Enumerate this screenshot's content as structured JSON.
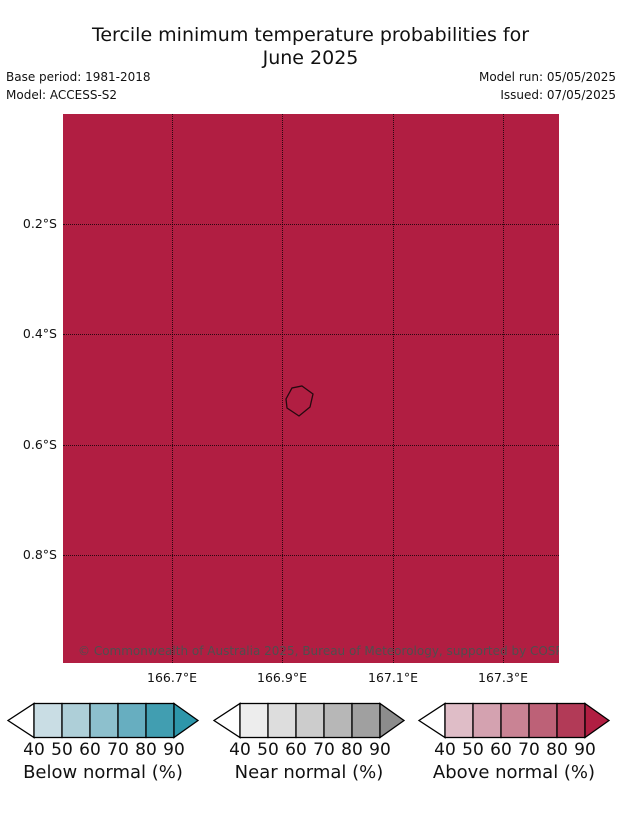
{
  "title": {
    "line1": "Tercile minimum temperature probabilities for",
    "line2": "June 2025"
  },
  "meta": {
    "base_period": "Base period: 1981-2018",
    "model": "Model: ACCESS-S2",
    "model_run": "Model run: 05/05/2025",
    "issued": "Issued: 07/05/2025"
  },
  "map": {
    "fill_color": "#b11e42",
    "island_outline_color": "#24090f",
    "copyright": "© Commonwealth of Australia 2025, Bureau of Meteorology, supported by COSPPac",
    "lat_ticks": [
      "0.2°S",
      "0.4°S",
      "0.6°S",
      "0.8°S"
    ],
    "lon_ticks": [
      "166.7°E",
      "166.9°E",
      "167.1°E",
      "167.3°E"
    ]
  },
  "legends": [
    {
      "label": "Below normal (%)",
      "ticks": [
        "40",
        "50",
        "60",
        "70",
        "80",
        "90"
      ],
      "segments": [
        "#c9dde4",
        "#aecfd8",
        "#8dc0cd",
        "#67aec0",
        "#419eb1"
      ],
      "more_arrow_color": "#2d96aa",
      "less_arrow_color": "#ffffff"
    },
    {
      "label": "Near normal (%)",
      "ticks": [
        "40",
        "50",
        "60",
        "70",
        "80",
        "90"
      ],
      "segments": [
        "#ededed",
        "#dddddd",
        "#cccccc",
        "#b7b7b7",
        "#a0a0a0"
      ],
      "more_arrow_color": "#8c8c8c",
      "less_arrow_color": "#ffffff"
    },
    {
      "label": "Above normal (%)",
      "ticks": [
        "40",
        "50",
        "60",
        "70",
        "80",
        "90"
      ],
      "segments": [
        "#dfbdc7",
        "#d4a2b0",
        "#c98394",
        "#bd6177",
        "#b23a57"
      ],
      "more_arrow_color": "#b11e42",
      "less_arrow_color": "#ffffff"
    }
  ],
  "chart_data": {
    "type": "map",
    "title": "Tercile minimum temperature probabilities for June 2025",
    "lat_axis_ticks": [
      "0.2°S",
      "0.4°S",
      "0.6°S",
      "0.8°S"
    ],
    "lon_axis_ticks": [
      "166.7°E",
      "166.9°E",
      "167.1°E",
      "167.3°E"
    ],
    "legend_scales": [
      "Below normal (%)",
      "Near normal (%)",
      "Above normal (%)"
    ],
    "legend_tick_values": [
      40,
      50,
      60,
      70,
      80,
      90
    ],
    "region_fill_class": "Above normal > 90%"
  }
}
